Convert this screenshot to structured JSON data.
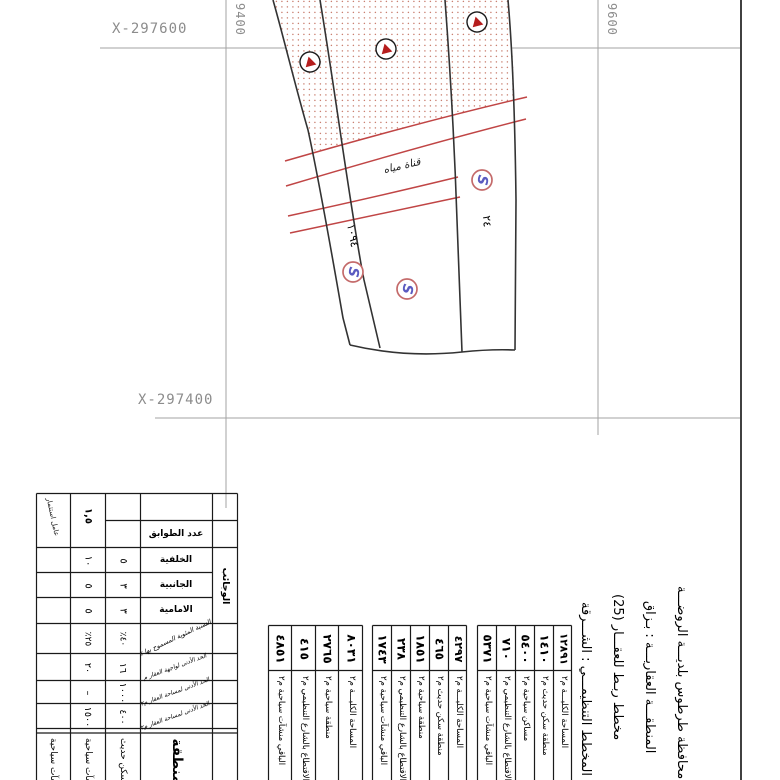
{
  "map": {
    "grid": {
      "x_label_top": "X-297600",
      "x_label_bottom": "X-297400",
      "y_label_left": "9400",
      "y_label_right": "9600"
    },
    "road_label": "قناة مياه",
    "parcel_number_left": "١٠٩٤",
    "parcel_number_right": "٢٤",
    "s_glyph": "S",
    "colors": {
      "road_red": "#c04545",
      "dot_fill": "#c98070",
      "triangle_red": "#b51d1d",
      "s_blue": "#5b5bc0",
      "s_ring": "#c46a6a"
    }
  },
  "reg": {
    "investment_label": "عامل استثمار",
    "investment_value": "١,٥",
    "floors_label": "عدد الطوابق",
    "setbacks_label": "الوجائب",
    "rows": [
      {
        "label": "الخلفية",
        "v1": "٥",
        "v2": "١٠"
      },
      {
        "label": "الجانبية",
        "v1": "٣",
        "v2": "٥"
      },
      {
        "label": "الامامية",
        "v1": "٣",
        "v2": "٥"
      },
      {
        "label": "النسبة المئوية المسموح بها ٪",
        "v1": "٤٠٪",
        "v2": "٢٥٪"
      },
      {
        "label": "الحد الأدنى لواجهة العقار م",
        "v1": "١٦",
        "v2": "٢٠"
      },
      {
        "label": "الحد الأدنى لمساحة العقار م٢",
        "v1": "١٠٠٠",
        "v2": "–"
      },
      {
        "label": "الحد الأدنى لمساحة العقار م٢",
        "v1": "٤٠٠",
        "v2": "١٥٠٠"
      }
    ],
    "zone": {
      "label": "منطقة",
      "zone1": "سكن حديث",
      "zone2": "منشآت سياحية",
      "zone3": "منشآت سياحية"
    }
  },
  "areas": {
    "groups": [
      {
        "cols": [
          {
            "v": "٤٨٥١",
            "l": "الباقي منشآت سياحية م٢"
          },
          {
            "v": "٤١٥",
            "l": "الاقتطاع بالشارع التنظيمي م٢"
          },
          {
            "v": "٢٧٦٥",
            "l": "منطقة سياحية م٢"
          },
          {
            "v": "٨٠٣١",
            "l": "المساحة الكليـــة م٢"
          }
        ]
      },
      {
        "cols": [
          {
            "v": "١٧٤٣",
            "l": "الباقي منشآت سياحية م٢"
          },
          {
            "v": "٢٣٨",
            "l": "الاقتطاع بالشارع التنظيمي م٢"
          },
          {
            "v": "١٨٥١",
            "l": "منطقة سياحية م٢"
          },
          {
            "v": "٤٦٥",
            "l": "منطقة سكن حديث م٢"
          },
          {
            "v": "٤٢٩٧",
            "l": "المساحة الكليـــة م٢"
          }
        ]
      },
      {
        "cols": [
          {
            "v": "٥٣٧١",
            "l": "الباقي منشآت سياحية م٢"
          },
          {
            "v": "٧١٠",
            "l": "الاقتطاع بالشارع التنظيمي م٢"
          },
          {
            "v": "٥٤٠٠",
            "l": "مساكن سياحية م٢"
          },
          {
            "v": "١٤١٠",
            "l": "منطقة سكن حديث م٢"
          },
          {
            "v": "١٢٨٩١",
            "l": "المساحة الكليـــة م٢"
          }
        ]
      }
    ]
  },
  "titles": {
    "municipality": "محافظة طرطوس       بلديـــة الروضـــة",
    "cadastral_zone": "المنطقـــة العقاريـــة : بـزاق",
    "plan_title": "مخطط ربـط للعقـــار (25)",
    "master_plan": "المخطط التنظيمـــي : الشـــرقة"
  }
}
